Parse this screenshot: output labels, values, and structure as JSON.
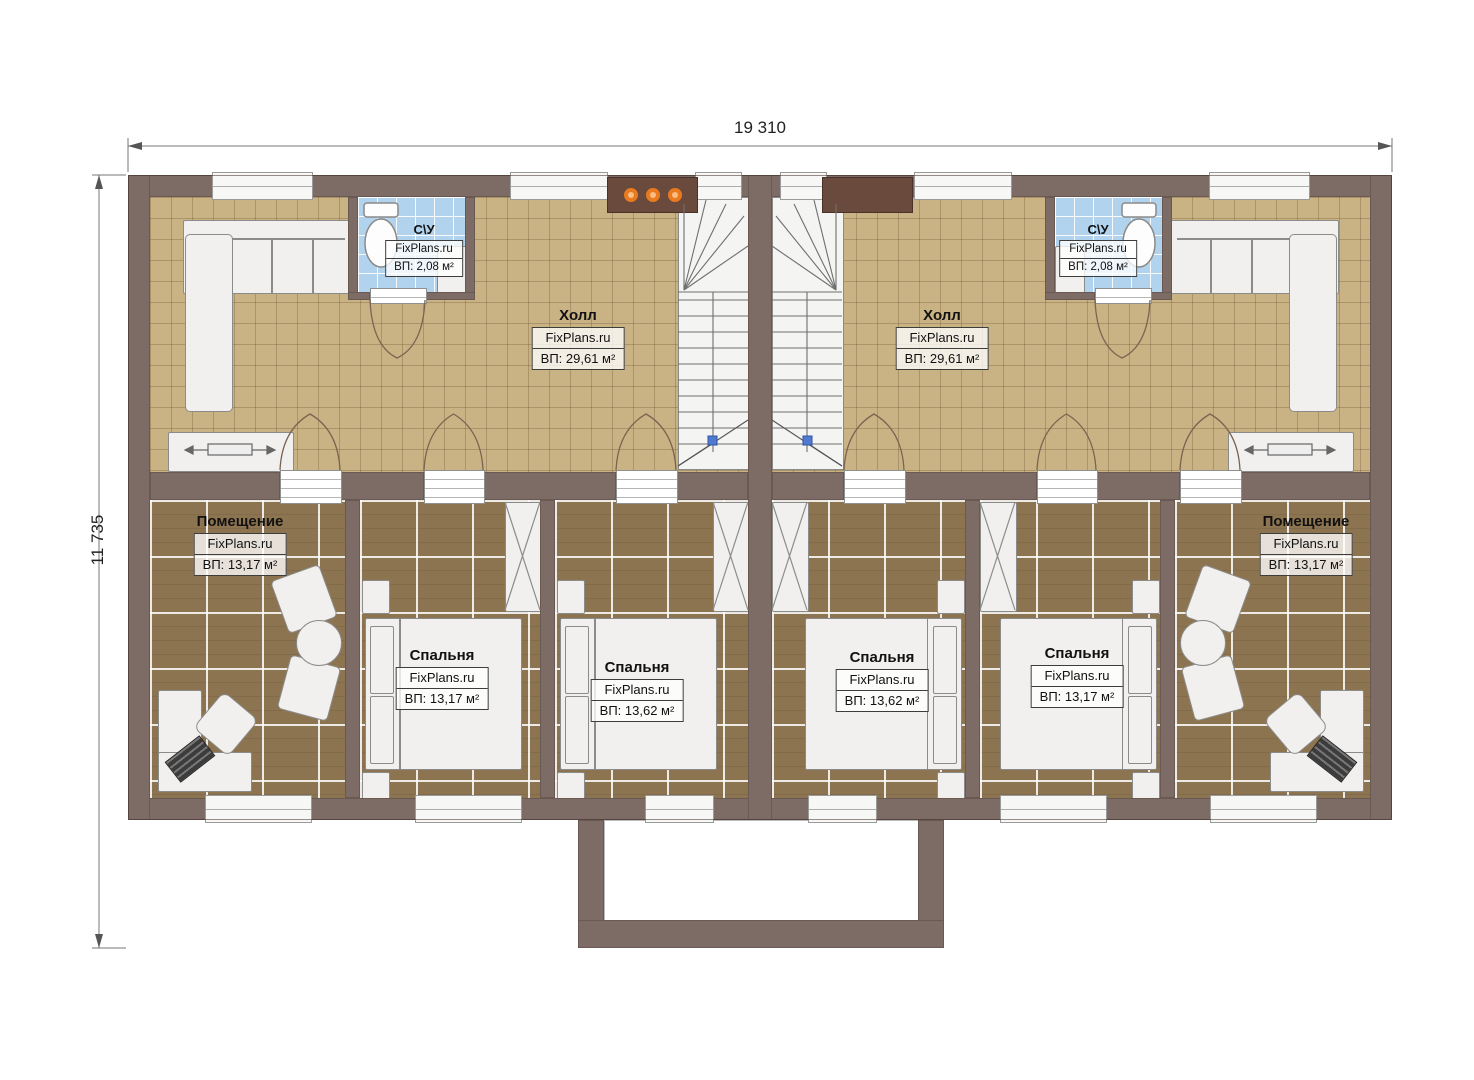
{
  "title": "Floor plan",
  "watermark": "FixPlans.ru",
  "dimensions": {
    "width": "19 310",
    "height": "11 735"
  },
  "rooms": {
    "hall_left": {
      "name": "Холл",
      "area": "ВП: 29,61 м²"
    },
    "hall_right": {
      "name": "Холл",
      "area": "ВП: 29,61 м²"
    },
    "bath_left": {
      "name": "С\\У",
      "area": "ВП: 2,08 м²"
    },
    "bath_right": {
      "name": "С\\У",
      "area": "ВП: 2,08 м²"
    },
    "utility_left": {
      "name": "Помещение",
      "area": "ВП: 13,17 м²"
    },
    "utility_right": {
      "name": "Помещение",
      "area": "ВП: 13,17 м²"
    },
    "bedroom_1": {
      "name": "Спальня",
      "area": "ВП: 13,17 м²"
    },
    "bedroom_2": {
      "name": "Спальня",
      "area": "ВП: 13,62 м²"
    },
    "bedroom_3": {
      "name": "Спальня",
      "area": "ВП: 13,62 м²"
    },
    "bedroom_4": {
      "name": "Спальня",
      "area": "ВП: 13,17 м²"
    }
  },
  "colors": {
    "wall": "#7d6b66",
    "hall_floor": "#c9b384",
    "room_floor": "#8d7451",
    "bath_floor": "#b2d3ee",
    "accent_dots": "#e97a1f"
  }
}
